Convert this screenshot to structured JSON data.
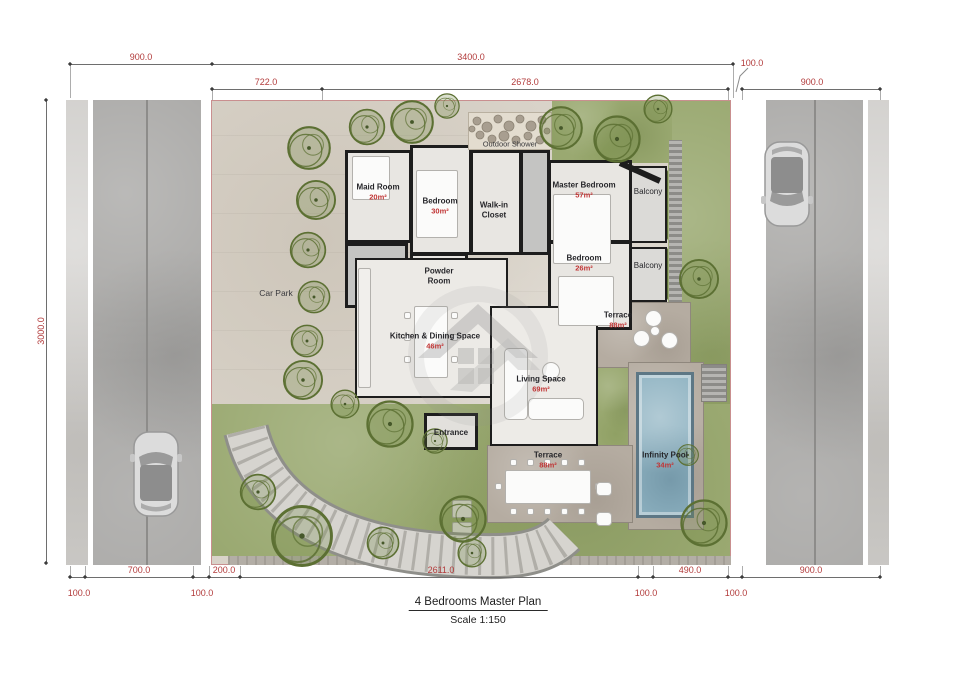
{
  "title_block": {
    "title": "4 Bedrooms Master Plan",
    "scale": "Scale 1:150"
  },
  "dimensions": {
    "top_row1": [
      "900.0",
      "3400.0"
    ],
    "top_row2": [
      "722.0",
      "2678.0",
      "100.0",
      "900.0"
    ],
    "left": "3000.0",
    "bottom_above": [
      "700.0",
      "200.0",
      "2611.0",
      "490.0",
      "900.0"
    ],
    "bottom_below": [
      "100.0",
      "100.0",
      "100.0",
      "100.0"
    ]
  },
  "rooms": [
    {
      "name": "Maid Room",
      "area": "20m²"
    },
    {
      "name": "Bedroom",
      "area": "30m²"
    },
    {
      "name": "Walk-in Closet",
      "area": ""
    },
    {
      "name": "Outdoor Shower",
      "area": ""
    },
    {
      "name": "Master Bedroom",
      "area": "57m²"
    },
    {
      "name": "Balcony",
      "area": ""
    },
    {
      "name": "Bedroom",
      "area": "26m²"
    },
    {
      "name": "Balcony",
      "area": ""
    },
    {
      "name": "Powder Room",
      "area": ""
    },
    {
      "name": "Kitchen & Dining Space",
      "area": "46m²"
    },
    {
      "name": "Living Space",
      "area": "69m²"
    },
    {
      "name": "Terrace",
      "area": "88m²"
    },
    {
      "name": "Entrance",
      "area": ""
    },
    {
      "name": "Terrace",
      "area": "88m²"
    },
    {
      "name": "Infinity Pool",
      "area": "34m²"
    },
    {
      "name": "Car Park",
      "area": ""
    }
  ],
  "colors": {
    "dimension_red": "#b23b3b",
    "area_red": "#c13535",
    "grass_green": "#9aa971",
    "tree_green": "#5c7033",
    "pool_blue": "#8fb3c2",
    "road_gray": "#a7a6a4",
    "hardscape": "#d9d3c9",
    "terrace_taupe": "#b5aca1",
    "wall_black": "#1d1d1d"
  }
}
